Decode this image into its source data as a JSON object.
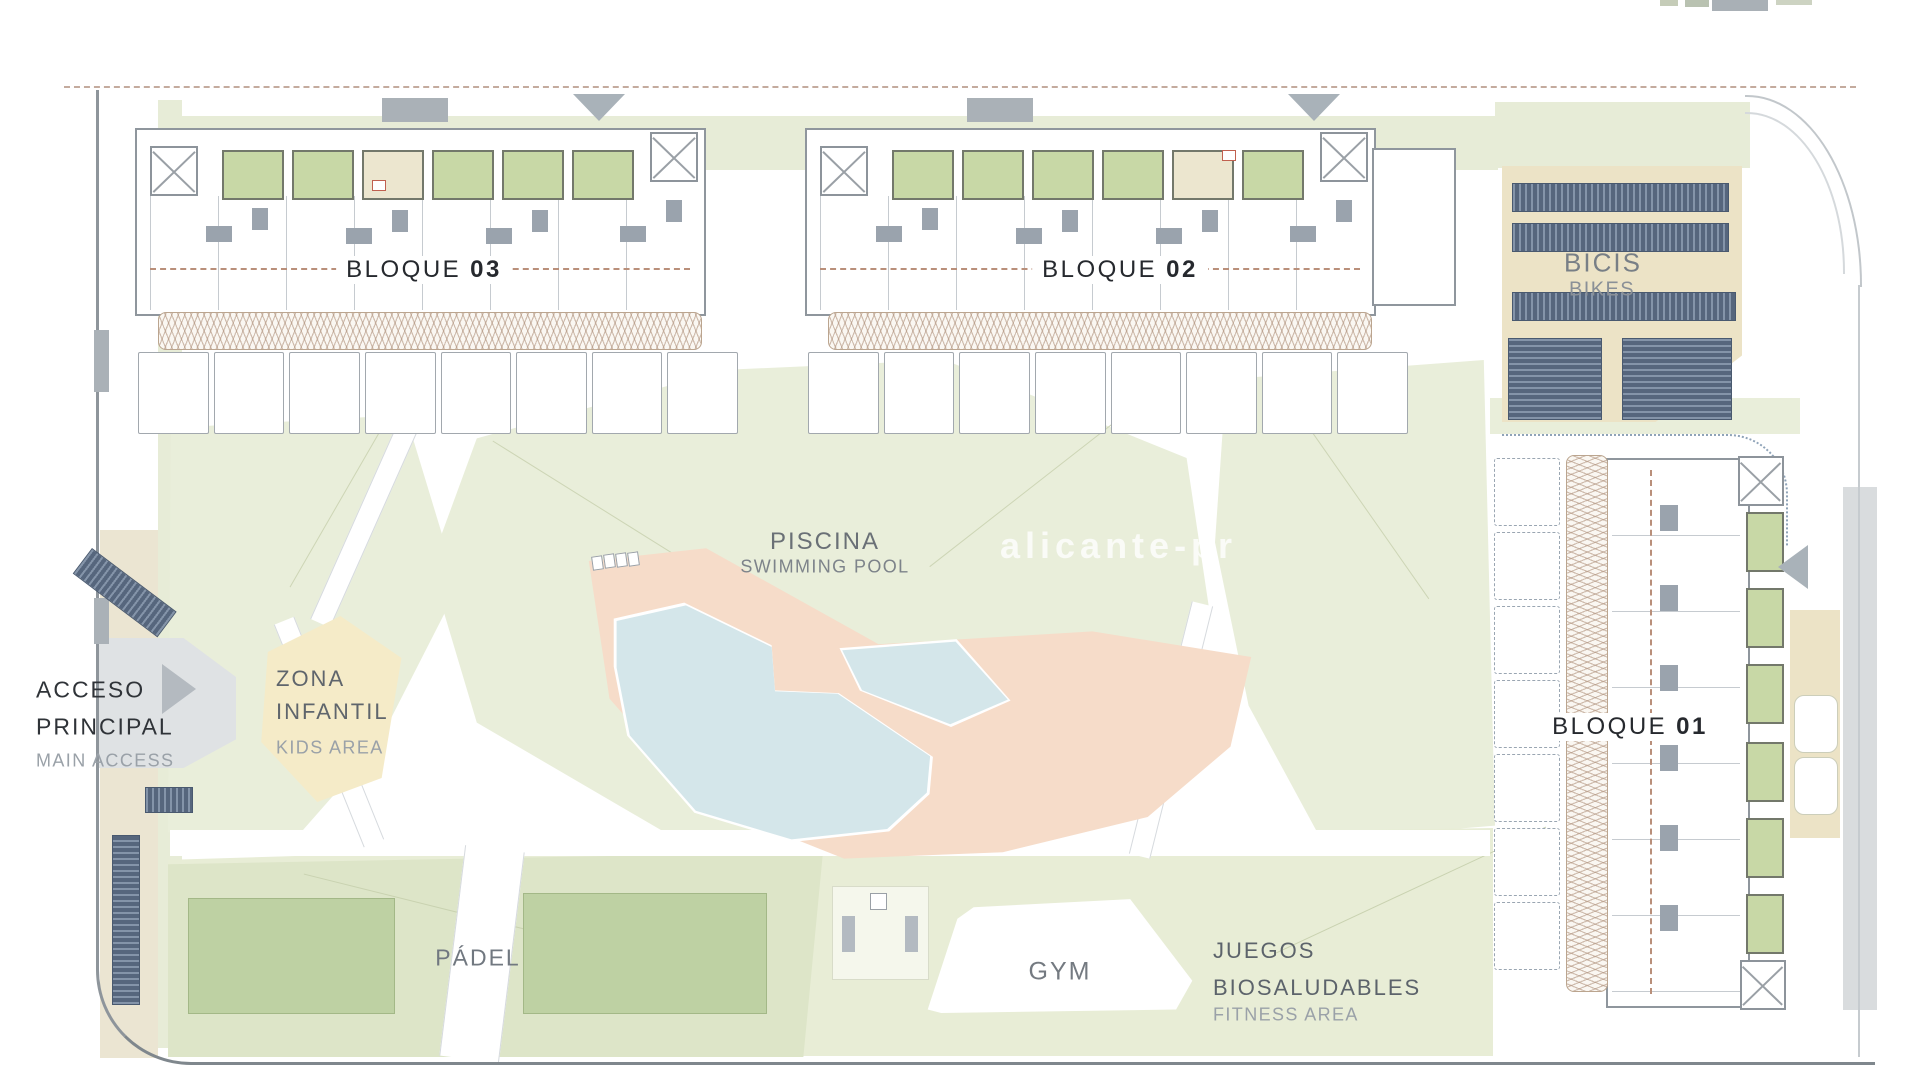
{
  "labels": {
    "bloque03": {
      "name": "BLOQUE",
      "number": "03"
    },
    "bloque02": {
      "name": "BLOQUE",
      "number": "02"
    },
    "bloque01": {
      "name": "BLOQUE",
      "number": "01"
    },
    "bicis": {
      "primary": "BICIS",
      "secondary": "BIKES"
    },
    "piscina": {
      "primary": "PISCINA",
      "secondary": "SWIMMING POOL"
    },
    "zona_infantil": {
      "line1": "ZONA",
      "line2": "INFANTIL",
      "secondary": "KIDS AREA"
    },
    "acceso_principal": {
      "line1": "ACCESO",
      "line2": "PRINCIPAL",
      "secondary": "MAIN ACCESS"
    },
    "padel": {
      "primary": "PÁDEL"
    },
    "gym": {
      "primary": "GYM"
    },
    "juegos_biosaludables": {
      "line1": "JUEGOS",
      "line2": "BIOSALUDABLES",
      "secondary": "FITNESS AREA"
    }
  },
  "watermark": "alicante-pr",
  "colors": {
    "site_green": "#e9eeda",
    "lawn_shade": "#dde5c8",
    "garden_green": "#c8d8a6",
    "padel_green": "#bed1a3",
    "tan": "#ece3c6",
    "pool_blue": "#d4e6ea",
    "deck_salmon": "#f6dcc9",
    "kids_yellow": "#f5ebc8",
    "rack_slate": "#5c6d84",
    "outline_gray": "#8f969d",
    "text_dark": "#26292e",
    "text_medium": "#5f666d",
    "text_light": "#9aa1a8",
    "dash_brown": "#b98f7a"
  }
}
